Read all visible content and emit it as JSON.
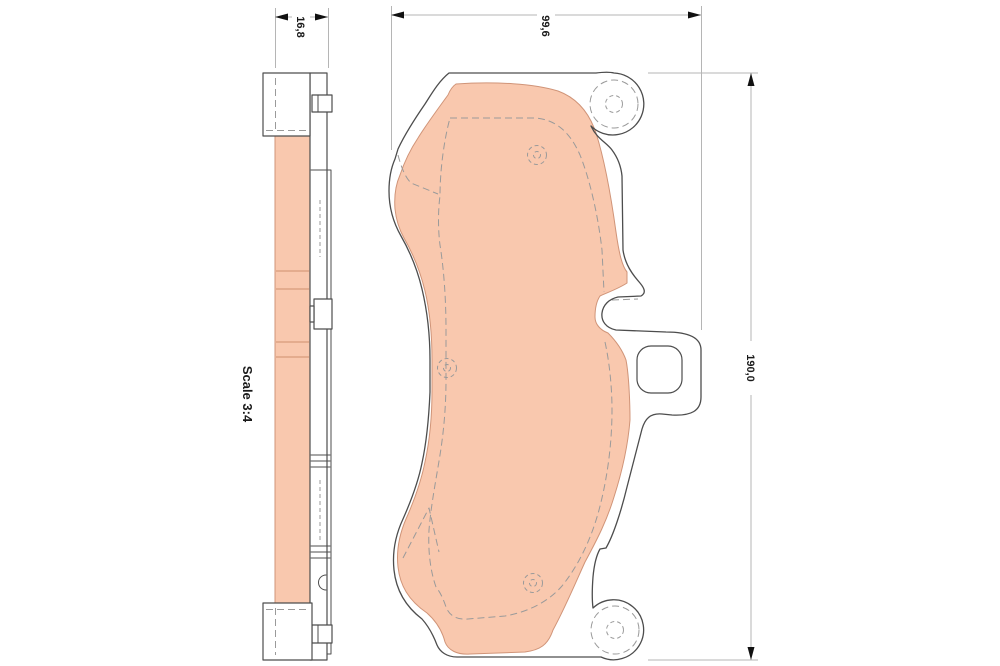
{
  "drawing": {
    "scale_label": "Scale 3:4",
    "dim_thickness": "16,8",
    "dim_width": "99,6",
    "dim_height": "190,0"
  },
  "colors": {
    "background": "#ffffff",
    "friction": "#f9c8ae",
    "friction_edge": "#d09478",
    "seam": "#cf8f6f",
    "outline": "#4d4d4d",
    "dashed": "#9a9a9a",
    "dim_line": "#b5b5b5",
    "arrow": "#111111",
    "text": "#1a1a1a"
  }
}
